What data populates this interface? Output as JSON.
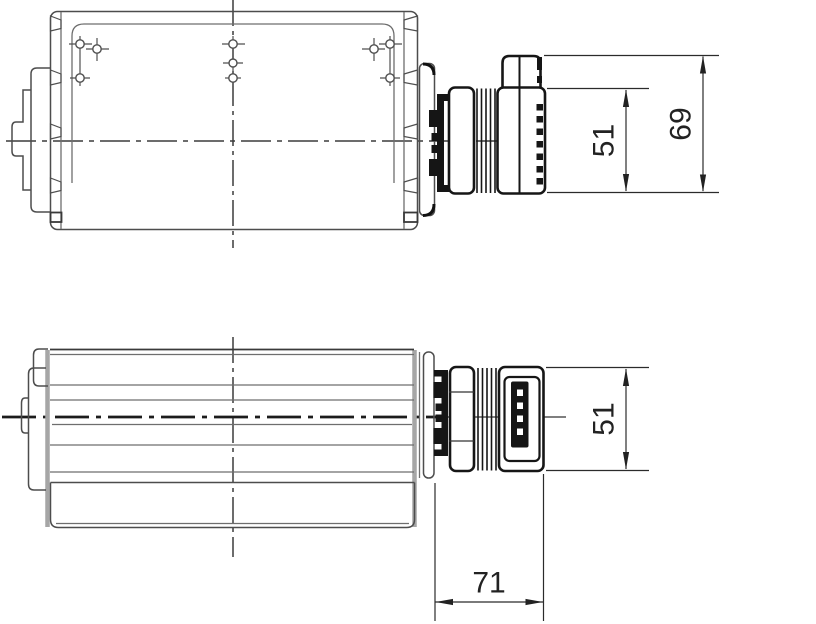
{
  "drawing": {
    "type": "technical-drawing",
    "subject": "cross-flow fan with motor, two orthographic views",
    "colors": {
      "background": "#ffffff",
      "outline": "#4d4d4d",
      "motor": "#161616",
      "dimension": "#222222"
    },
    "views": {
      "top_view": {
        "dimensions": {
          "motor_body_height": "51",
          "motor_overall_height": "69"
        }
      },
      "front_view": {
        "dimensions": {
          "motor_body_height": "51",
          "motor_length": "71"
        }
      }
    }
  }
}
